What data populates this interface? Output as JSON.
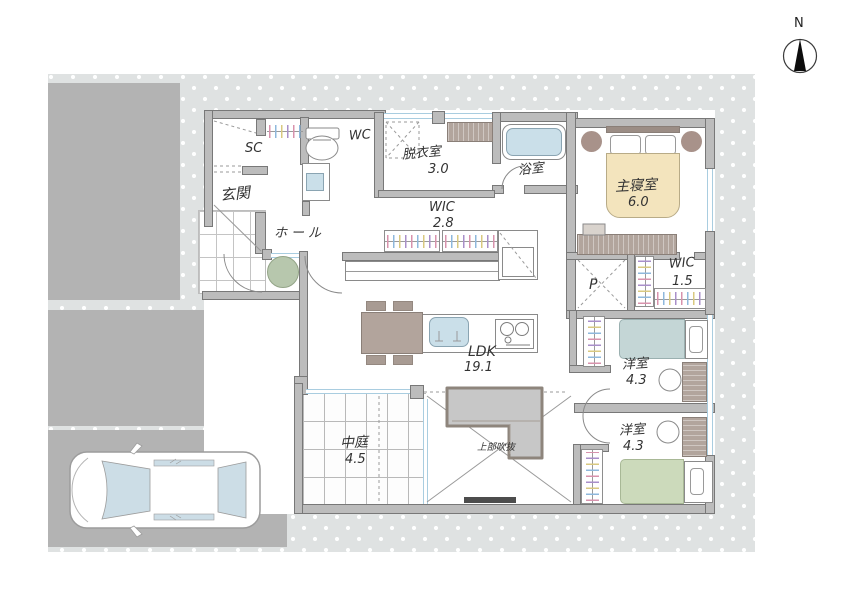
{
  "compass": {
    "label": "N"
  },
  "rooms": {
    "genkan": {
      "label": "玄関"
    },
    "shoe_closet": {
      "label": "SC"
    },
    "wc": {
      "label": "WC"
    },
    "dressing_room": {
      "label": "脱衣室",
      "area": "3.0"
    },
    "bathroom": {
      "label": "浴室"
    },
    "master_bedroom": {
      "label": "主寝室",
      "area": "6.0"
    },
    "hall": {
      "label": "ホール"
    },
    "wic_upper": {
      "label": "WIC",
      "area": "2.8"
    },
    "pantry": {
      "label": "P"
    },
    "wic_master": {
      "label": "WIC",
      "area": "1.5"
    },
    "ldk": {
      "label": "LDK",
      "area": "19.1"
    },
    "courtyard": {
      "label": "中庭",
      "area": "4.5"
    },
    "bedroom_upper": {
      "label": "洋室",
      "area": "4.3"
    },
    "bedroom_lower": {
      "label": "洋室",
      "area": "4.3"
    },
    "void_above": {
      "label": "上部吹抜"
    }
  },
  "colors": {
    "wall": "#bcbcbc",
    "wall_outline": "#787878",
    "site_gray": "#b3b3b3",
    "dotted_background": "#dfe2e2",
    "water_blue": "#cadfe9",
    "window_blue": "#a9cde0",
    "bed_master": "#f3e4bd",
    "bed_upper_room": "#c4d6d6",
    "bed_lower_room": "#ccdabb",
    "wood_brown": "#b2a59d",
    "sofa_gray": "#c7c7c7",
    "plant_green": "#b7c7ad"
  }
}
